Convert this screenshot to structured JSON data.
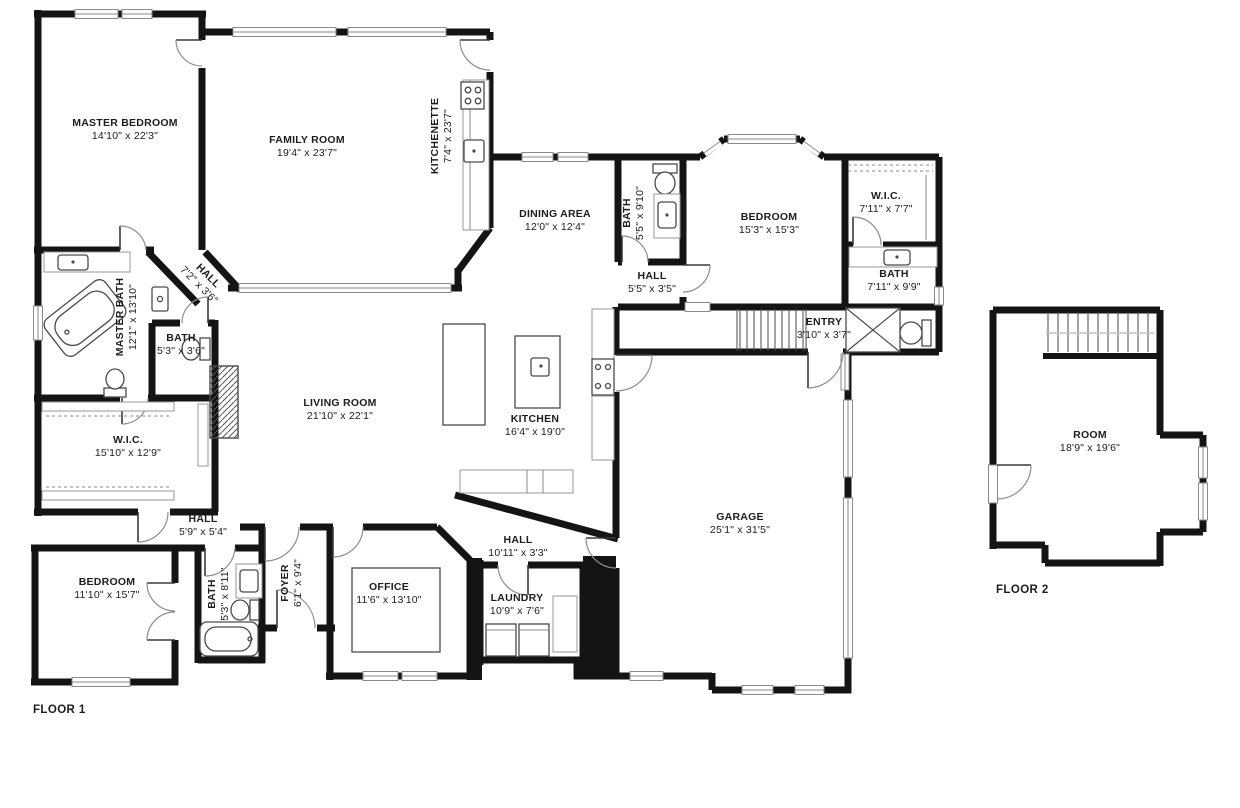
{
  "floor1": {
    "label": "FLOOR 1",
    "rooms": {
      "master_bedroom": {
        "name": "MASTER BEDROOM",
        "dims": "14'10\" x 22'3\""
      },
      "family_room": {
        "name": "FAMILY ROOM",
        "dims": "19'4\" x 23'7\""
      },
      "kitchenette": {
        "name": "KITCHENETTE",
        "dims": "7'4\" x 23'7\""
      },
      "dining_area": {
        "name": "DINING AREA",
        "dims": "12'0\" x 12'4\""
      },
      "bath_upper": {
        "name": "BATH",
        "dims": "5'5\" x 9'10\""
      },
      "hall_upper": {
        "name": "HALL",
        "dims": "5'5\" x 3'5\""
      },
      "bedroom_ne": {
        "name": "BEDROOM",
        "dims": "15'3\" x 15'3\""
      },
      "wic_ne": {
        "name": "W.I.C.",
        "dims": "7'11\" x 7'7\""
      },
      "bath_ne": {
        "name": "BATH",
        "dims": "7'11\" x 9'9\""
      },
      "entry": {
        "name": "ENTRY",
        "dims": "3'10\" x 3'7\""
      },
      "master_bath": {
        "name": "MASTER BATH",
        "dims": "12'1\" x 13'10\""
      },
      "hall_diagonal": {
        "name": "HALL",
        "dims": "7'2\" x 3'6\""
      },
      "bath_small": {
        "name": "BATH",
        "dims": "5'3\" x 3'6\""
      },
      "living_room": {
        "name": "LIVING ROOM",
        "dims": "21'10\" x 22'1\""
      },
      "kitchen": {
        "name": "KITCHEN",
        "dims": "16'4\" x 19'0\""
      },
      "wic_w": {
        "name": "W.I.C.",
        "dims": "15'10\" x 12'9\""
      },
      "hall_sw": {
        "name": "HALL",
        "dims": "5'9\" x 5'4\""
      },
      "bedroom_sw": {
        "name": "BEDROOM",
        "dims": "11'10\" x 15'7\""
      },
      "bath_sw": {
        "name": "BATH",
        "dims": "5'3\" x 8'11\""
      },
      "foyer": {
        "name": "FOYER",
        "dims": "6'1\" x 9'4\""
      },
      "office": {
        "name": "OFFICE",
        "dims": "11'6\" x 13'10\""
      },
      "hall_s": {
        "name": "HALL",
        "dims": "10'11\" x 3'3\""
      },
      "laundry": {
        "name": "LAUNDRY",
        "dims": "10'9\" x 7'6\""
      },
      "garage": {
        "name": "GARAGE",
        "dims": "25'1\" x 31'5\""
      }
    }
  },
  "floor2": {
    "label": "FLOOR 2",
    "rooms": {
      "room": {
        "name": "ROOM",
        "dims": "18'9\" x 19'6\""
      }
    }
  }
}
